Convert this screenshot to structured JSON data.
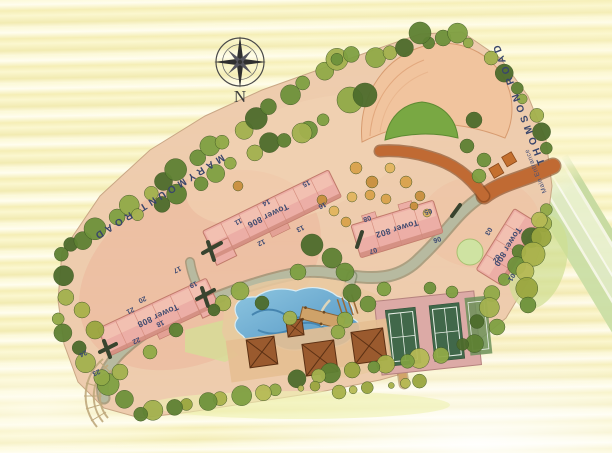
{
  "plan": {
    "compass_label": "N",
    "road_labels": {
      "marymount": "MARYMOUNT ROAD",
      "thomson": "THOMSON ROAD"
    },
    "entrance_label": "Main Entrance",
    "towers": [
      {
        "label": "Tower 806",
        "x": 268,
        "y": 216,
        "angle": 154
      },
      {
        "label": "Tower 802",
        "x": 397,
        "y": 229,
        "angle": 163
      },
      {
        "label": "Tower 800",
        "x": 508,
        "y": 247,
        "angle": 122
      },
      {
        "label": "Tower 808",
        "x": 158,
        "y": 316,
        "angle": 155
      }
    ],
    "unit_markers": [
      {
        "label": "01",
        "x": 511,
        "y": 277,
        "angle": 122
      },
      {
        "label": "02",
        "x": 496,
        "y": 258,
        "angle": 122
      },
      {
        "label": "03",
        "x": 488,
        "y": 231,
        "angle": 122
      },
      {
        "label": "05",
        "x": 428,
        "y": 211,
        "angle": 162
      },
      {
        "label": "06",
        "x": 437,
        "y": 239,
        "angle": 162
      },
      {
        "label": "07",
        "x": 373,
        "y": 250,
        "angle": 162
      },
      {
        "label": "08",
        "x": 367,
        "y": 218,
        "angle": 162
      },
      {
        "label": "11",
        "x": 238,
        "y": 221,
        "angle": 154
      },
      {
        "label": "12",
        "x": 261,
        "y": 242,
        "angle": 154
      },
      {
        "label": "13",
        "x": 300,
        "y": 228,
        "angle": 154
      },
      {
        "label": "14",
        "x": 266,
        "y": 202,
        "angle": 154
      },
      {
        "label": "15",
        "x": 306,
        "y": 183,
        "angle": 154
      },
      {
        "label": "16",
        "x": 322,
        "y": 205,
        "angle": 154
      },
      {
        "label": "17",
        "x": 177,
        "y": 269,
        "angle": 154
      },
      {
        "label": "18",
        "x": 160,
        "y": 323,
        "angle": 154
      },
      {
        "label": "19",
        "x": 193,
        "y": 284,
        "angle": 154
      },
      {
        "label": "20",
        "x": 142,
        "y": 299,
        "angle": 154
      },
      {
        "label": "21",
        "x": 130,
        "y": 310,
        "angle": 154
      },
      {
        "label": "22",
        "x": 136,
        "y": 340,
        "angle": 154
      },
      {
        "label": "23",
        "x": 96,
        "y": 372,
        "angle": 154
      },
      {
        "label": "24",
        "x": 83,
        "y": 353,
        "angle": 154
      }
    ],
    "colors": {
      "label_ink": "#3a4668",
      "building_pink": "#ecaea6",
      "pool_blue": "#5598c8",
      "tree_green": "#5e8133",
      "driveway_terracotta": "#c06a33",
      "paper_yellow": "#faf6cc"
    }
  }
}
